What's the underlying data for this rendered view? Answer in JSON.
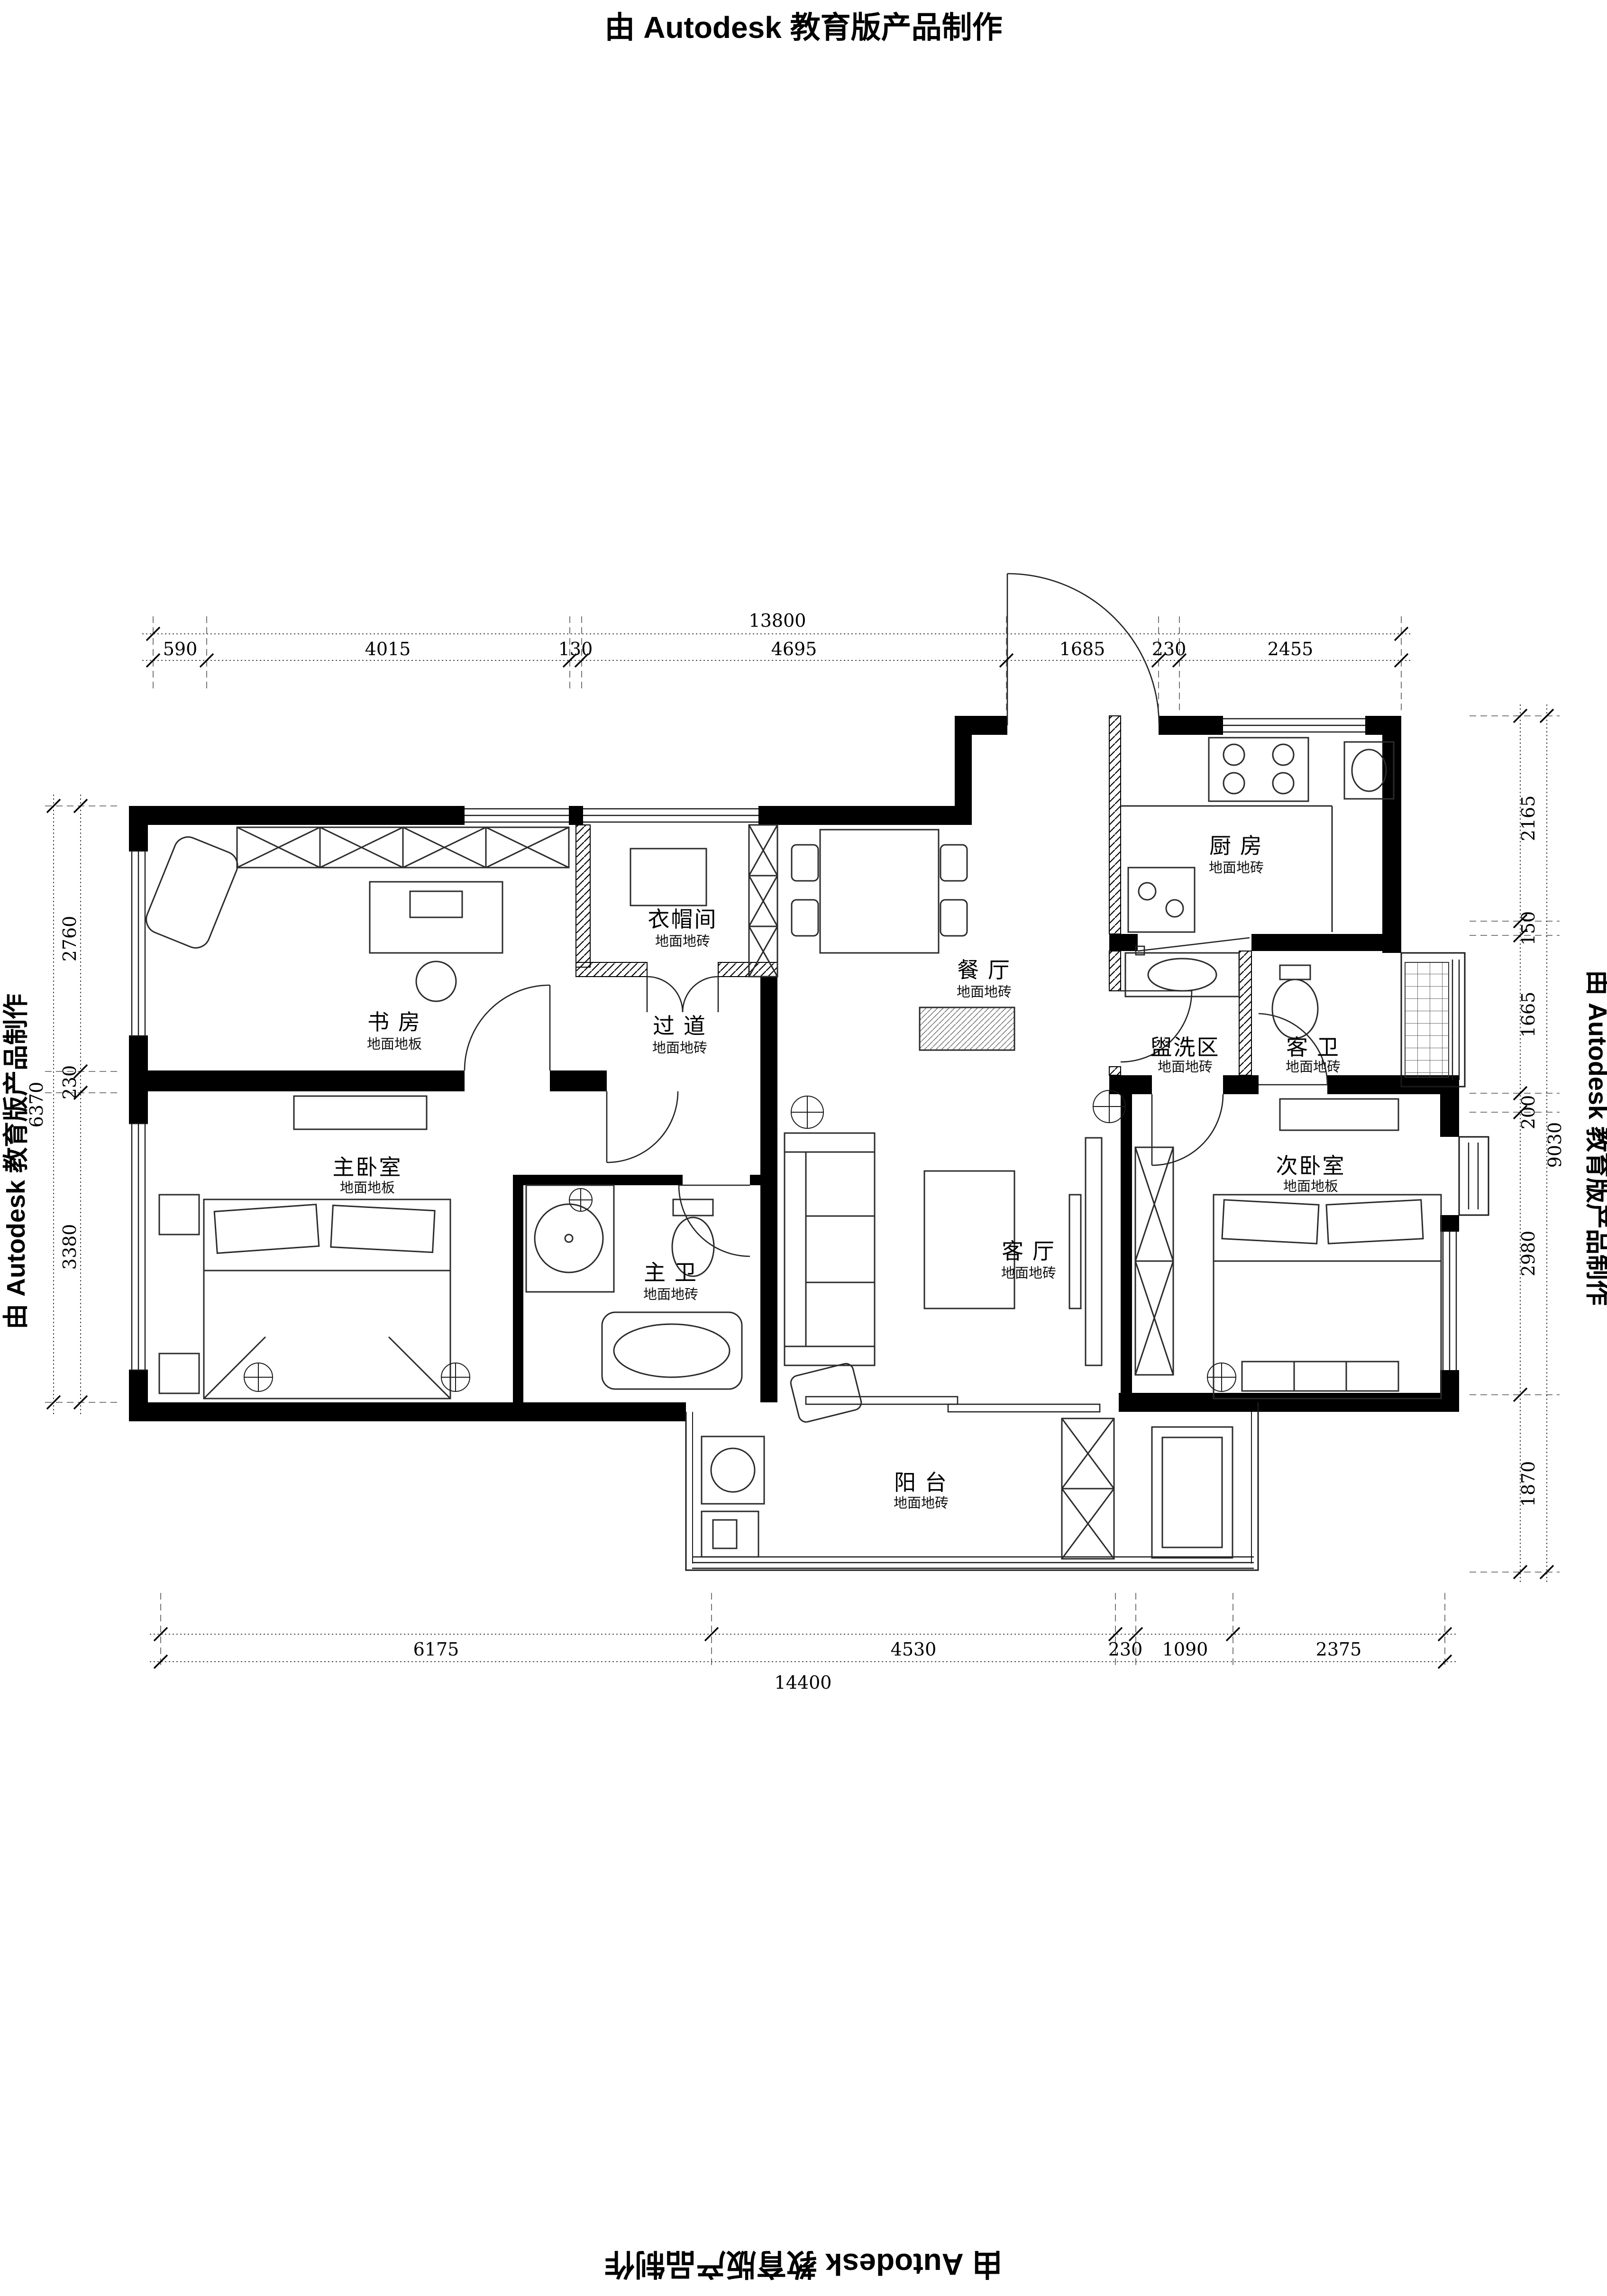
{
  "watermark": {
    "text": "由 Autodesk 教育版产品制作"
  },
  "rooms": [
    {
      "id": "study",
      "name": "书 房",
      "floor": "地面地板"
    },
    {
      "id": "cloakroom",
      "name": "衣帽间",
      "floor": "地面地砖"
    },
    {
      "id": "hallway",
      "name": "过 道",
      "floor": "地面地砖"
    },
    {
      "id": "dining",
      "name": "餐 厅",
      "floor": "地面地砖"
    },
    {
      "id": "kitchen",
      "name": "厨 房",
      "floor": "地面地砖"
    },
    {
      "id": "wash-area",
      "name": "盥洗区",
      "floor": "地面地砖"
    },
    {
      "id": "guest-bath",
      "name": "客 卫",
      "floor": "地面地砖"
    },
    {
      "id": "master-bedroom",
      "name": "主卧室",
      "floor": "地面地板"
    },
    {
      "id": "master-bath",
      "name": "主 卫",
      "floor": "地面地砖"
    },
    {
      "id": "living",
      "name": "客 厅",
      "floor": "地面地砖"
    },
    {
      "id": "second-bedroom",
      "name": "次卧室",
      "floor": "地面地板"
    },
    {
      "id": "balcony",
      "name": "阳 台",
      "floor": "地面地砖"
    }
  ],
  "dimensions": {
    "top": {
      "total": "13800",
      "segments": [
        "590",
        "4015",
        "130",
        "4695",
        "1685",
        "230",
        "2455"
      ]
    },
    "bottom": {
      "total": "14400",
      "segments": [
        "6175",
        "4530",
        "230",
        "1090",
        "2375"
      ]
    },
    "left": {
      "total": "6370",
      "segments": [
        "2760",
        "230",
        "3380"
      ]
    },
    "right": {
      "total": "9030",
      "segments": [
        "2165",
        "150",
        "1665",
        "200",
        "2980",
        "1870"
      ]
    }
  },
  "colors": {
    "wall": "#000000",
    "line": "#2b2b2b",
    "background": "#ffffff"
  }
}
